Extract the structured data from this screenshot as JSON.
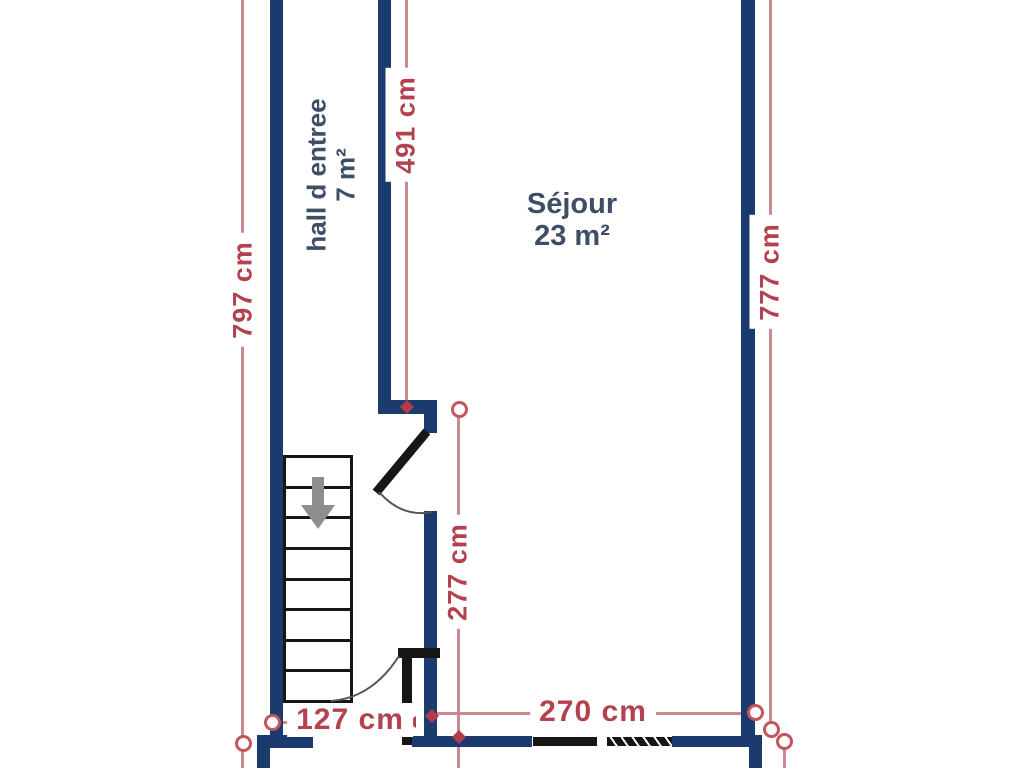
{
  "plan_title": "floor-plan-ground-level",
  "rooms": {
    "hall": {
      "label": "hall d entree",
      "area": "7 m²"
    },
    "sejour": {
      "label": "Séjour",
      "area": "23 m²"
    }
  },
  "dimensions": {
    "left_total": "797 cm",
    "hall_vertical": "491 cm",
    "right_total": "777 cm",
    "inner_vertical": "277 cm",
    "hall_bottom": "127 cm",
    "sejour_bottom": "270 cm"
  },
  "colors": {
    "wall": "#1b3a6d",
    "door": "#161616",
    "dimension_text": "#b4424e",
    "dimension_line": "#c9898e",
    "room_label": "#3e4e66",
    "stair_arrow": "#8e8e8e"
  }
}
